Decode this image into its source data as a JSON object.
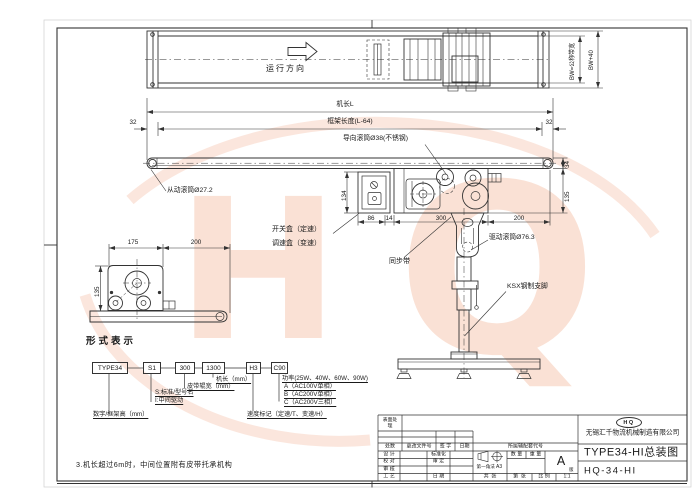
{
  "watermark": {
    "logo_h": "H",
    "logo_q": "Q",
    "color": "#f8d3c2"
  },
  "top_view": {
    "direction": "运行方向",
    "bw_inner": "BW=公称带宽",
    "bw_outer": "BW+40"
  },
  "dims": {
    "machine_length": "机长L",
    "frame_length": "框架长度(L-64)",
    "end_left": "32",
    "end_right": "32",
    "box_height": "134",
    "d86": "86",
    "d14": "14",
    "d300": "300",
    "d200": "200",
    "belt_34": "34",
    "drive_135": "135",
    "ev_175": "175",
    "ev_200": "200",
    "ev_135": "135"
  },
  "labels": {
    "driven_roller": "从动滚筒Ø27.2",
    "guide_roller": "导向滚筒Ø38(不锈钢)",
    "switch_box": "开关盒（定速）",
    "speed_box": "调速盒（变速）",
    "timing_belt": "同步带",
    "drive_roller": "驱动滚筒Ø76.3",
    "support_leg": "KSX钢制支脚"
  },
  "type_designation": {
    "heading": "形式表示",
    "boxes": [
      "TYPE34",
      "S1",
      "300",
      "1300",
      "H3",
      "C90"
    ],
    "machine_length": "机长（mm）",
    "belt_width": "皮带辊宽（mm）",
    "standard": "S:标准/型号名",
    "middle_drive": "I:中间驱动",
    "frame_height": "数字/框架高（mm）",
    "speed_mark": "速度标记（定速/T、变速/H）",
    "power": "功率(25W、40W、60W、90W)",
    "power_a": "A（AC100V单相）",
    "power_b": "B（AC200V单相）",
    "power_c": "C（AC200V三相）"
  },
  "note": "3.机长超过6m时，中间位置附有皮带托承机构",
  "title_block": {
    "surface_treatment": "表面处理",
    "col_qty": "处数",
    "col_doc": "更改文件号",
    "col_sign": "签 字",
    "col_date": "日期",
    "col_assembly": "所属辅配套代号",
    "design": "设 计",
    "proof": "校 对",
    "review": "审 核",
    "process": "工 艺",
    "standardization": "标准化",
    "approve": "审 定",
    "date": "日 期",
    "projection": "第一角法",
    "sheet_size": "A3",
    "qty": "数 量",
    "weight": "重 量",
    "version": "A",
    "version_suffix": "版",
    "total_sheets": "共  张",
    "page_no": "第  张",
    "scale_label": "比 例",
    "scale_value": "1:1",
    "logo": "HQ",
    "company": "无锡汇千物流机械制造有限公司",
    "drawing_title": "TYPE34-HI总装图",
    "drawing_no": "HQ-34-HI"
  }
}
